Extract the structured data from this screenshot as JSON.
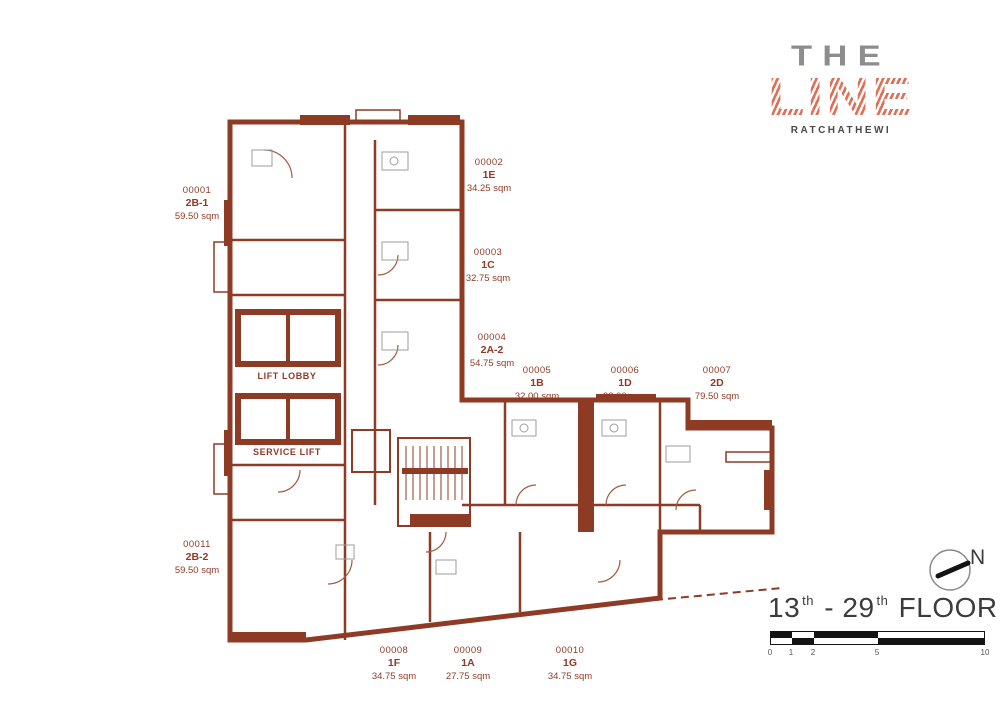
{
  "logo": {
    "brand_top": "THE",
    "brand_main": "LINE",
    "subtitle": "RATCHATHEWI"
  },
  "plan": {
    "core_labels": {
      "lift_lobby": "LIFT LOBBY",
      "service_lift": "SERVICE LIFT"
    },
    "units": [
      {
        "no": "00001",
        "type": "2B-1",
        "area": "59.50 sqm"
      },
      {
        "no": "00002",
        "type": "1E",
        "area": "34.25 sqm"
      },
      {
        "no": "00003",
        "type": "1C",
        "area": "32.75 sqm"
      },
      {
        "no": "00004",
        "type": "2A-2",
        "area": "54.75 sqm"
      },
      {
        "no": "00005",
        "type": "1B",
        "area": "32.00 sqm"
      },
      {
        "no": "00006",
        "type": "1D",
        "area": "33.00 sqm"
      },
      {
        "no": "00007",
        "type": "2D",
        "area": "79.50 sqm"
      },
      {
        "no": "00008",
        "type": "1F",
        "area": "34.75 sqm"
      },
      {
        "no": "00009",
        "type": "1A",
        "area": "27.75 sqm"
      },
      {
        "no": "00010",
        "type": "1G",
        "area": "34.75 sqm"
      },
      {
        "no": "00011",
        "type": "2B-2",
        "area": "59.50 sqm"
      }
    ]
  },
  "footer": {
    "north_label": "N",
    "title": {
      "from": "13",
      "from_sup": "th",
      "sep": "-",
      "to": "29",
      "to_sup": "th",
      "text": "FLOOR PLAN"
    },
    "scale_ticks": [
      "0",
      "1",
      "2",
      "5",
      "10"
    ]
  }
}
